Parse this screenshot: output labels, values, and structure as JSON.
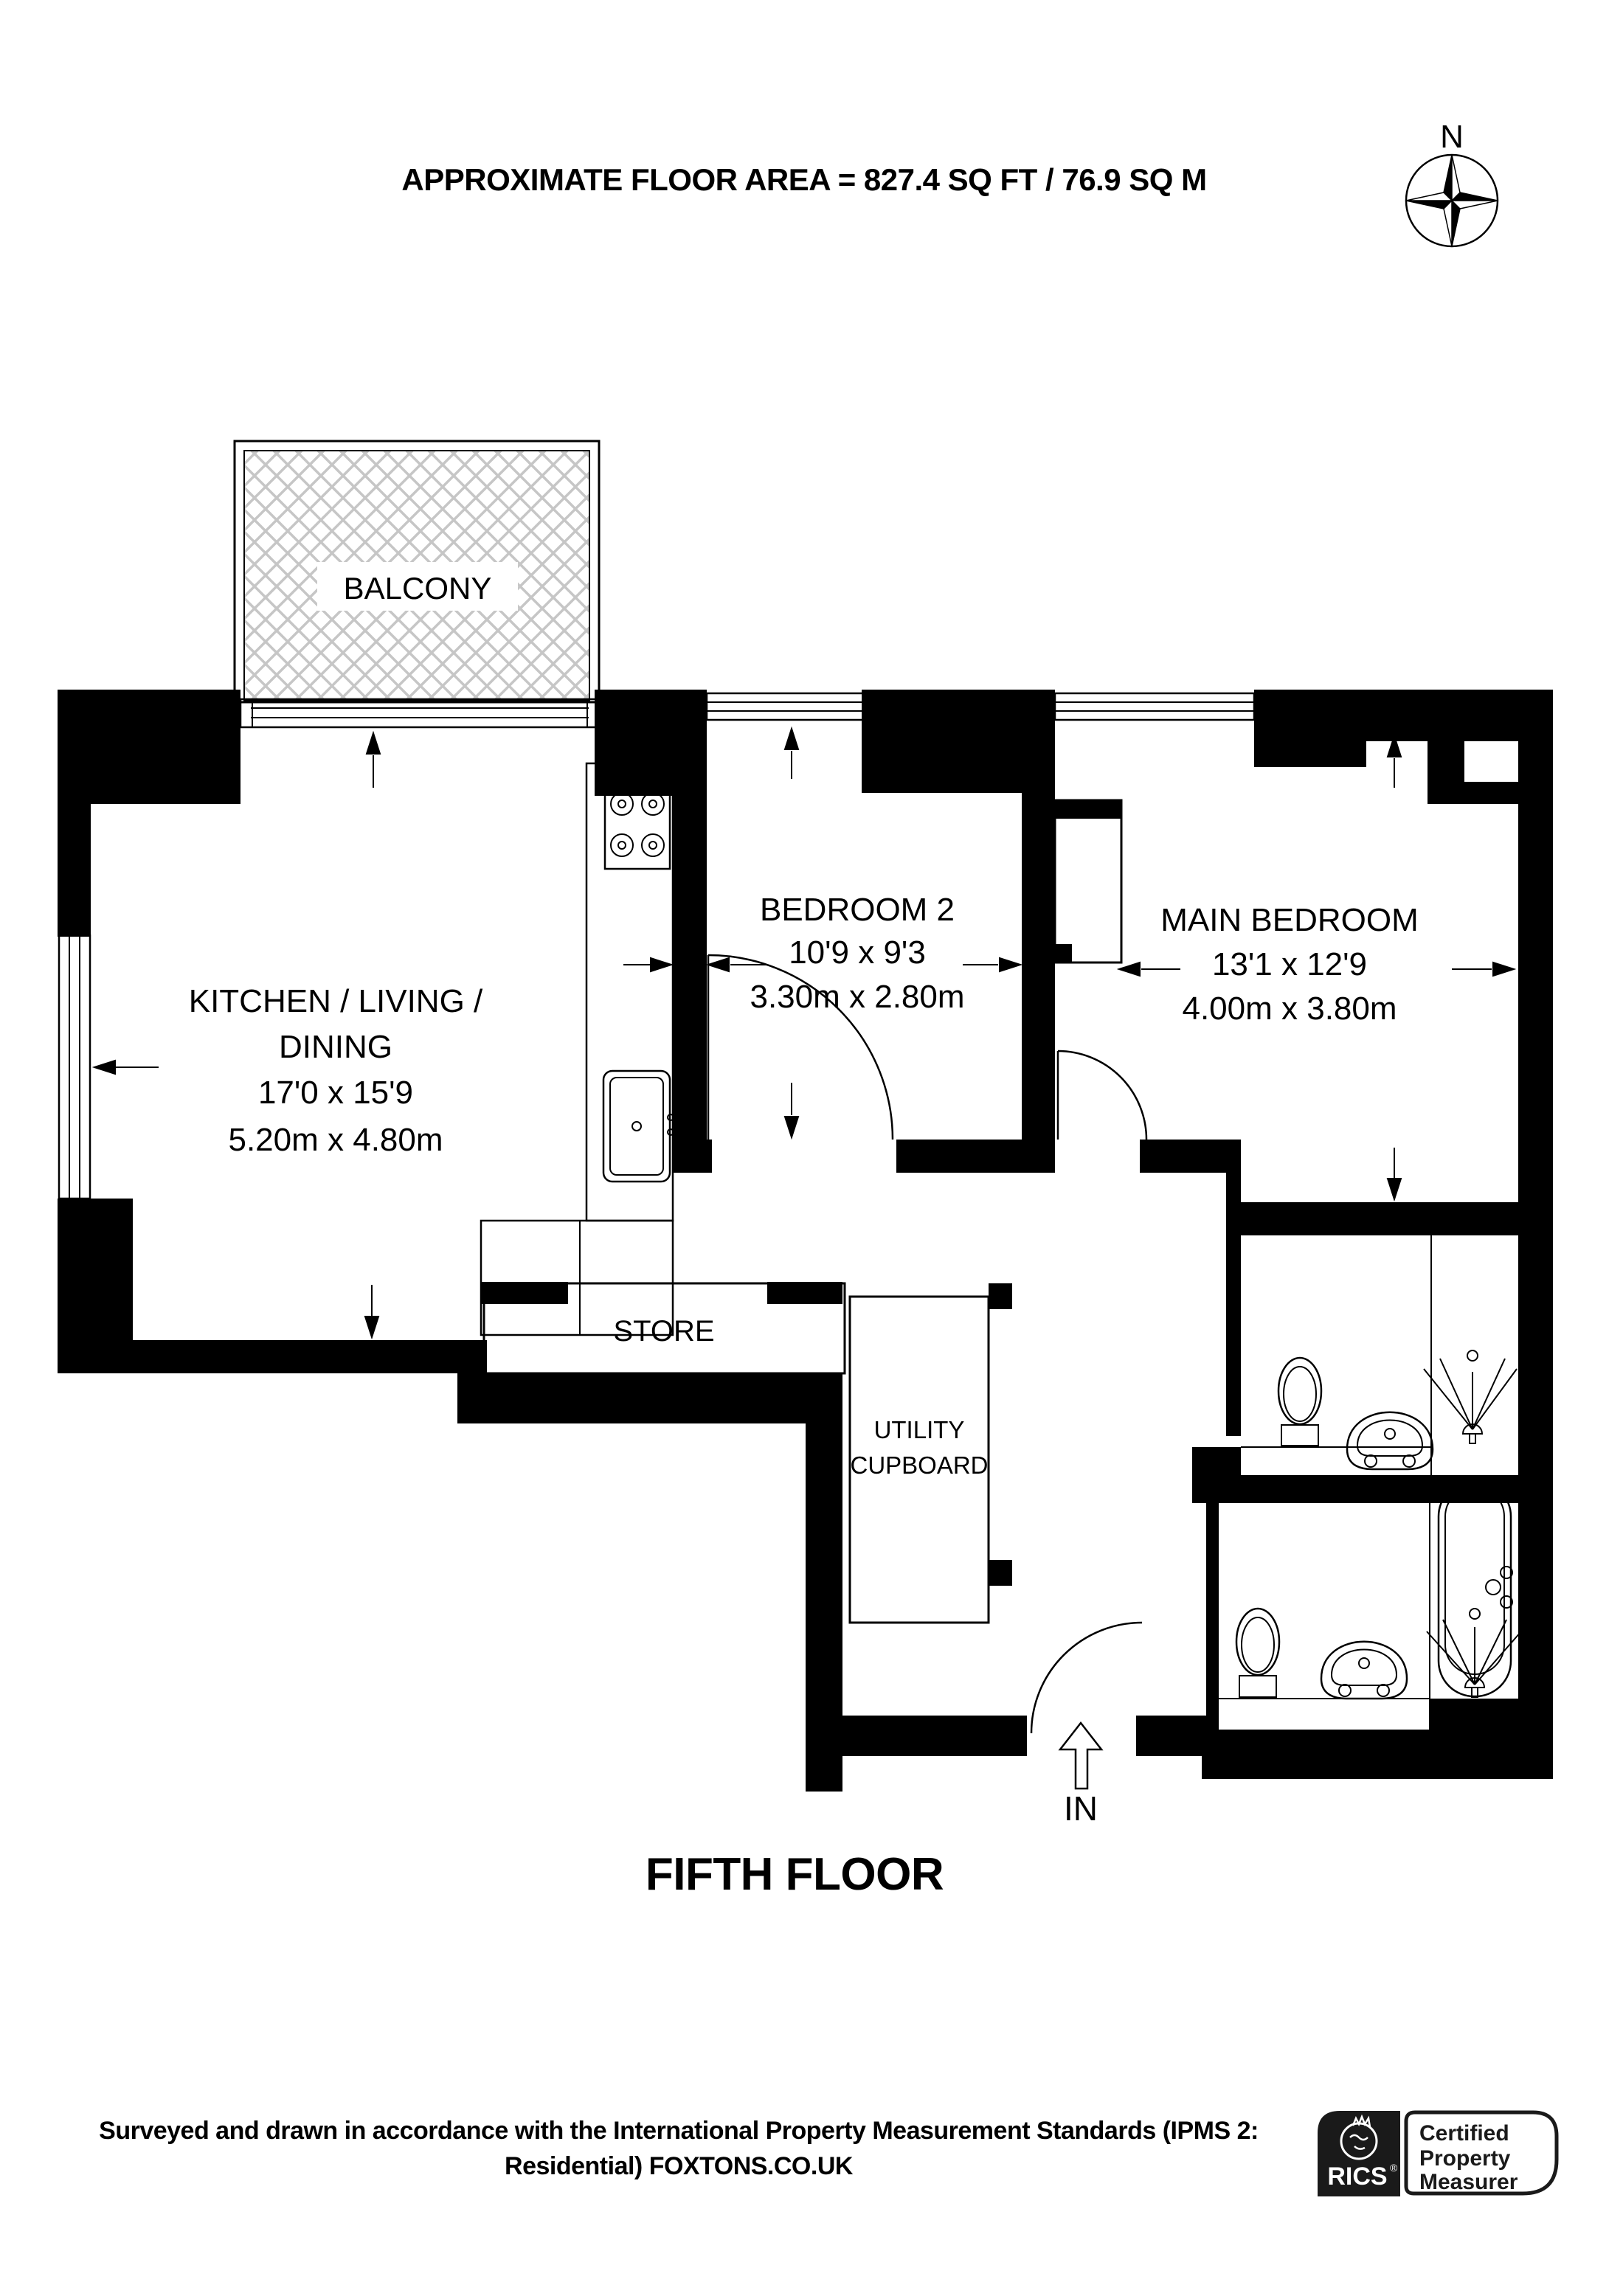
{
  "header": {
    "floor_area_label": "APPROXIMATE FLOOR AREA = 827.4 SQ FT / 76.9 SQ M"
  },
  "compass": {
    "north_label": "N"
  },
  "rooms": {
    "balcony": {
      "name": "BALCONY"
    },
    "kitchen": {
      "name_line1": "KITCHEN / LIVING /",
      "name_line2": "DINING",
      "dim_imperial": "17'0 x 15'9",
      "dim_metric": "5.20m x 4.80m"
    },
    "bedroom2": {
      "name": "BEDROOM 2",
      "dim_imperial": "10'9 x 9'3",
      "dim_metric": "3.30m x 2.80m"
    },
    "main_bedroom": {
      "name": "MAIN BEDROOM",
      "dim_imperial": "13'1 x 12'9",
      "dim_metric": "4.00m x 3.80m"
    },
    "store": {
      "name": "STORE"
    },
    "utility": {
      "name_line1": "UTILITY",
      "name_line2": "CUPBOARD"
    }
  },
  "entrance": {
    "label": "IN"
  },
  "floor_title": "FIFTH FLOOR",
  "footer": {
    "line1": "Surveyed and drawn in accordance with the International Property Measurement Standards (IPMS 2:",
    "line2": "Residential) FOXTONS.CO.UK"
  },
  "certification": {
    "org": "RICS",
    "registered_mark": "®",
    "line1": "Certified",
    "line2": "Property",
    "line3": "Measurer"
  },
  "colors": {
    "wall": "#000000",
    "hatch": "#c6c6c6",
    "background": "#ffffff"
  }
}
